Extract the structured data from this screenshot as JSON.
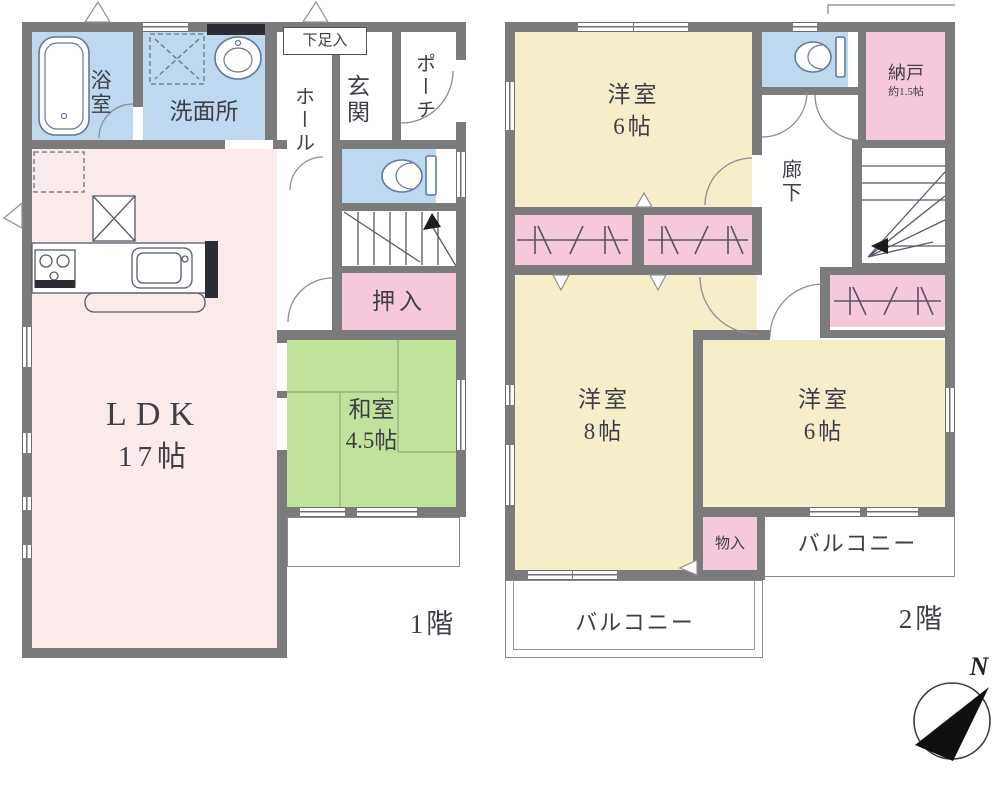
{
  "colors": {
    "wall": "#7b7b7b",
    "ldk": "#faeaea",
    "tatami": "#c1e29b",
    "bedroom": "#f6edc9",
    "closet": "#f6c8db",
    "water": "#bdd8ef",
    "line": "#565b66",
    "fixture": "#63799a",
    "ink": "#3e3e47"
  },
  "floor1": {
    "floor_label": "1階",
    "rooms": {
      "bath": "浴室",
      "washroom": "洗面所",
      "shoe_closet": "下足入",
      "hall": "ホール",
      "entrance": "玄関",
      "porch": "ポーチ",
      "closet": "押入",
      "japanese_room": "和室",
      "japanese_room_size": "4.5帖",
      "ldk": "LDK",
      "ldk_size": "17帖"
    }
  },
  "floor2": {
    "floor_label": "2階",
    "rooms": {
      "bedroom_nw": "洋室",
      "bedroom_nw_size": "6帖",
      "storeroom": "納戸",
      "storeroom_size": "約1.5帖",
      "corridor": "廊下",
      "bedroom_w": "洋室",
      "bedroom_w_size": "8帖",
      "bedroom_e": "洋室",
      "bedroom_e_size": "6帖",
      "storage": "物入",
      "balcony_east": "バルコニー",
      "balcony_south": "バルコニー"
    }
  },
  "compass": {
    "north": "N"
  }
}
